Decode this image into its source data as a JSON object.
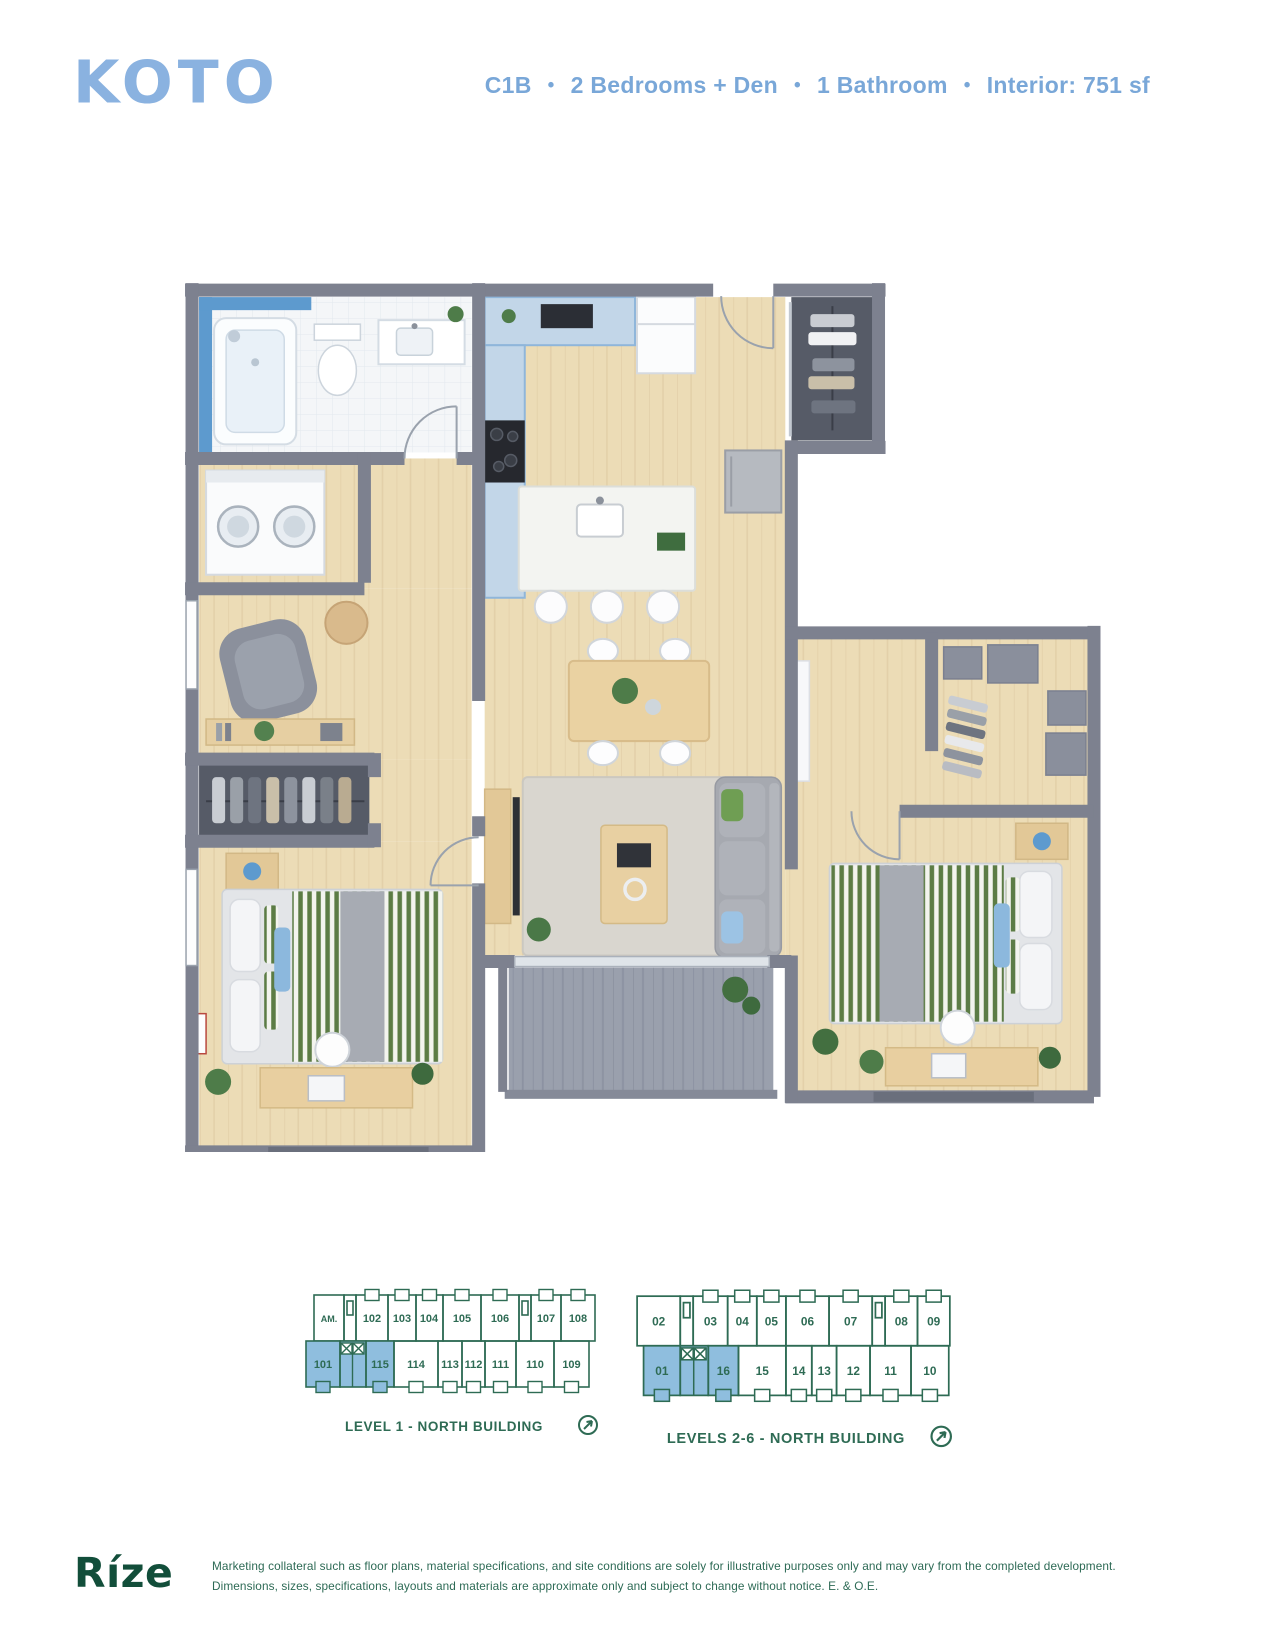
{
  "header": {
    "logo": "KOTO",
    "plan_code": "C1B",
    "separator": "•",
    "features": [
      "2 Bedrooms + Den",
      "1 Bathroom",
      "Interior: 751 sf"
    ]
  },
  "floor_plan": {
    "colors": {
      "wall_gray": "#7d818f",
      "floor_wood": "#ecdcb6",
      "cabinet_blue": "#6aa2d6",
      "counter_light_blue": "#c2d6e8",
      "balcony_gray": "#9aa0ad",
      "plant_green": "#4e7c49",
      "bedding_stripe_green": "#5c7c45",
      "pillow_blue": "#8cb8dd"
    }
  },
  "icons": {
    "compass": "arrow-northeast-circle",
    "elevator": "crossed-box-shaft"
  },
  "keyplans": [
    {
      "label": "LEVEL 1 - NORTH BUILDING",
      "top_units": [
        "AM.",
        "102",
        "103",
        "104",
        "105",
        "106",
        "107",
        "108"
      ],
      "bottom_units": [
        "101",
        "115",
        "114",
        "113",
        "112",
        "111",
        "110",
        "109"
      ],
      "highlighted_units": [
        "101",
        "115"
      ],
      "outline_color": "#2e6b54",
      "highlight_color": "#8fbede"
    },
    {
      "label": "LEVELS 2-6 - NORTH BUILDING",
      "top_units": [
        "02",
        "03",
        "04",
        "05",
        "06",
        "07",
        "08",
        "09"
      ],
      "bottom_units": [
        "01",
        "16",
        "15",
        "14",
        "13",
        "12",
        "11",
        "10"
      ],
      "highlighted_units": [
        "01",
        "16"
      ],
      "outline_color": "#2e6b54",
      "highlight_color": "#8fbede"
    }
  ],
  "footer": {
    "brand": "Ríze",
    "disclaimer": "Marketing collateral such as floor plans, material specifications, and site conditions are solely for illustrative purposes only and may vary from the completed development. Dimensions, sizes, specifications, layouts and materials are approximate only and subject to change without notice. E. & O.E."
  }
}
